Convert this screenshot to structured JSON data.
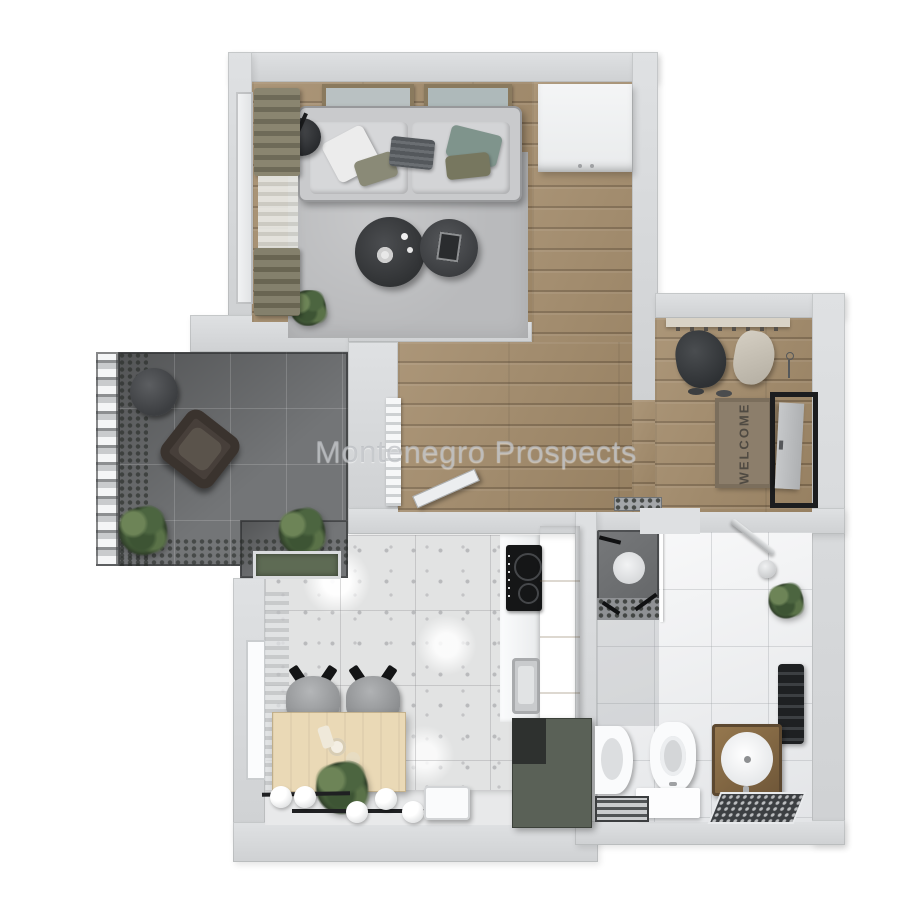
{
  "watermark": {
    "text": "Montenegro Prospects",
    "color": "#b2b5ba"
  },
  "entry": {
    "welcome_mat": {
      "text": "WELCOME",
      "mat_color": "#8c7e6b",
      "text_color": "#4f4a42"
    },
    "items": [
      "coat-rack",
      "hanging-coat",
      "hanging-bag",
      "shoes",
      "front-door",
      "doorbell-panel"
    ]
  },
  "rooms": [
    {
      "name": "living-room",
      "floor": "wood-with-gray-rug",
      "items": [
        "sofa",
        "pillows",
        "wall-art-frame-left",
        "wall-art-frame-right",
        "coffee-table-large",
        "coffee-table-small",
        "floor-lamp-side-table",
        "plant",
        "curtains",
        "window",
        "white-wardrobe"
      ]
    },
    {
      "name": "hallway",
      "floor": "wood",
      "items": [
        "radiator",
        "open-door-leaf",
        "doormat"
      ]
    },
    {
      "name": "balcony",
      "floor": "dark-tile",
      "items": [
        "railing",
        "round-table",
        "wicker-chair",
        "plant-left",
        "plant-right",
        "green-mat",
        "greenery-edge"
      ]
    },
    {
      "name": "kitchen",
      "floor": "terrazzo-tile",
      "items": [
        "dining-table",
        "chair-left",
        "chair-right",
        "pendant-globe-lights",
        "decor-plant",
        "step-stool",
        "induction-cooktop",
        "sink",
        "tall-cream-cabinet",
        "green-island-cabinet",
        "window-with-curtain"
      ]
    },
    {
      "name": "bathroom",
      "floor": "white-tile",
      "items": [
        "shower",
        "shower-glass",
        "shower-head",
        "plant",
        "towel-radiator",
        "toilet",
        "bidet",
        "vanity-sink",
        "white-bath-mat",
        "striped-rug",
        "dark-mosaic-mat",
        "doorway-threshold"
      ]
    }
  ],
  "palette": {
    "wall": "#d3d5d7",
    "wood": "#a28a69",
    "rug": "#b9babc",
    "balcony_tile": "#737577",
    "terrazzo": "#e2e3e3",
    "bath_tile": "#eff0f2",
    "cabinet_cream": "#eee2c6",
    "cabinet_green": "#5a6157",
    "door_frame": "#1c1d1f",
    "mat_brown": "#8c7e6b",
    "sofa": "#c9cacc",
    "table_wood": "#ead9b6",
    "plant_green": "#47603b"
  }
}
